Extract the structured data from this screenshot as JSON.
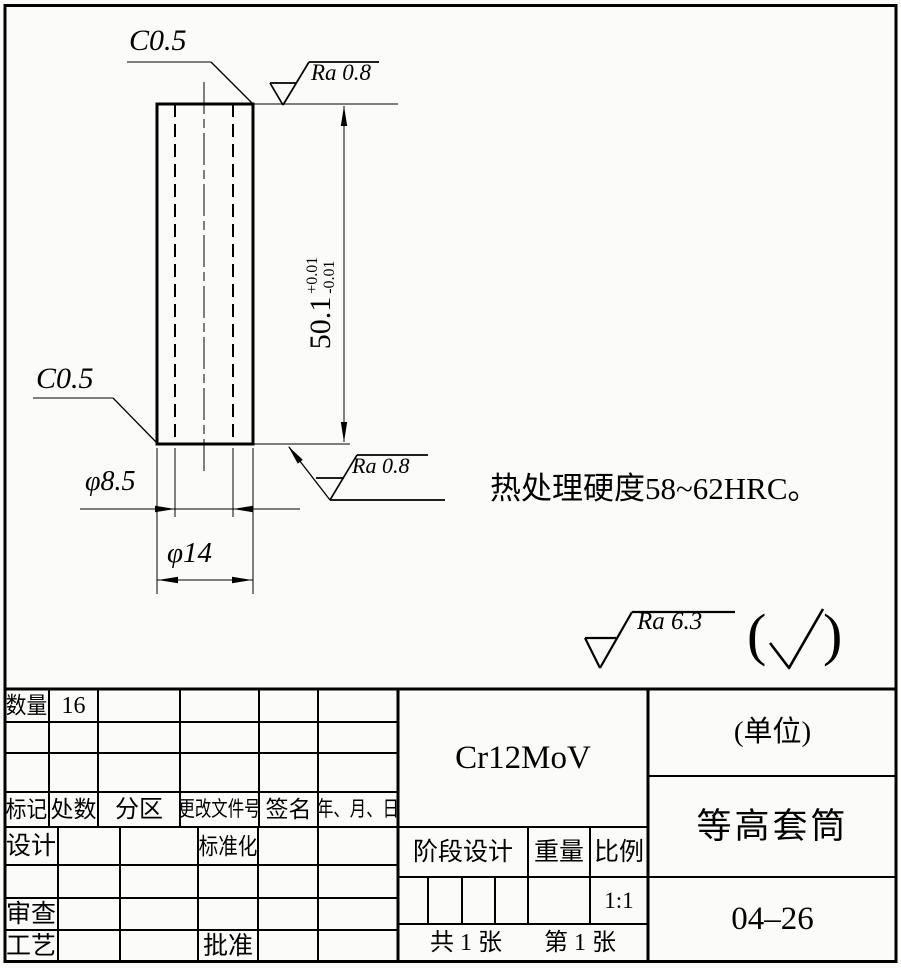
{
  "drawing": {
    "chamfer_top": "C0.5",
    "chamfer_bottom": "C0.5",
    "surface_top": "Ra 0.8",
    "surface_bottom": "Ra 0.8",
    "surface_general": "Ra 6.3",
    "paren_open": "(",
    "paren_close": ")",
    "height_value": "50.1",
    "height_tol_plus": "+0.01",
    "height_tol_minus": "-0.01",
    "bore_dia": "φ8.5",
    "outer_dia": "φ14",
    "note": "热处理硬度58~62HRC。"
  },
  "title_block": {
    "qty_label": "数量",
    "qty_value": "16",
    "rev_headers": [
      "标记",
      "处数",
      "分区",
      "更改文件号",
      "签名",
      "年、月、日"
    ],
    "design_label": "设计",
    "standardize_label": "标准化",
    "check_label": "审查",
    "process_label": "工艺",
    "approve_label": "批准",
    "material": "Cr12MoV",
    "unit": "(单位)",
    "part_name": "等高套筒",
    "stage_label": "阶段设计",
    "weight_label": "重量",
    "scale_label": "比例",
    "scale_value": "1:1",
    "total_sheets": "共 1 张",
    "sheet_number": "第 1 张",
    "drawing_number": "04–26"
  }
}
